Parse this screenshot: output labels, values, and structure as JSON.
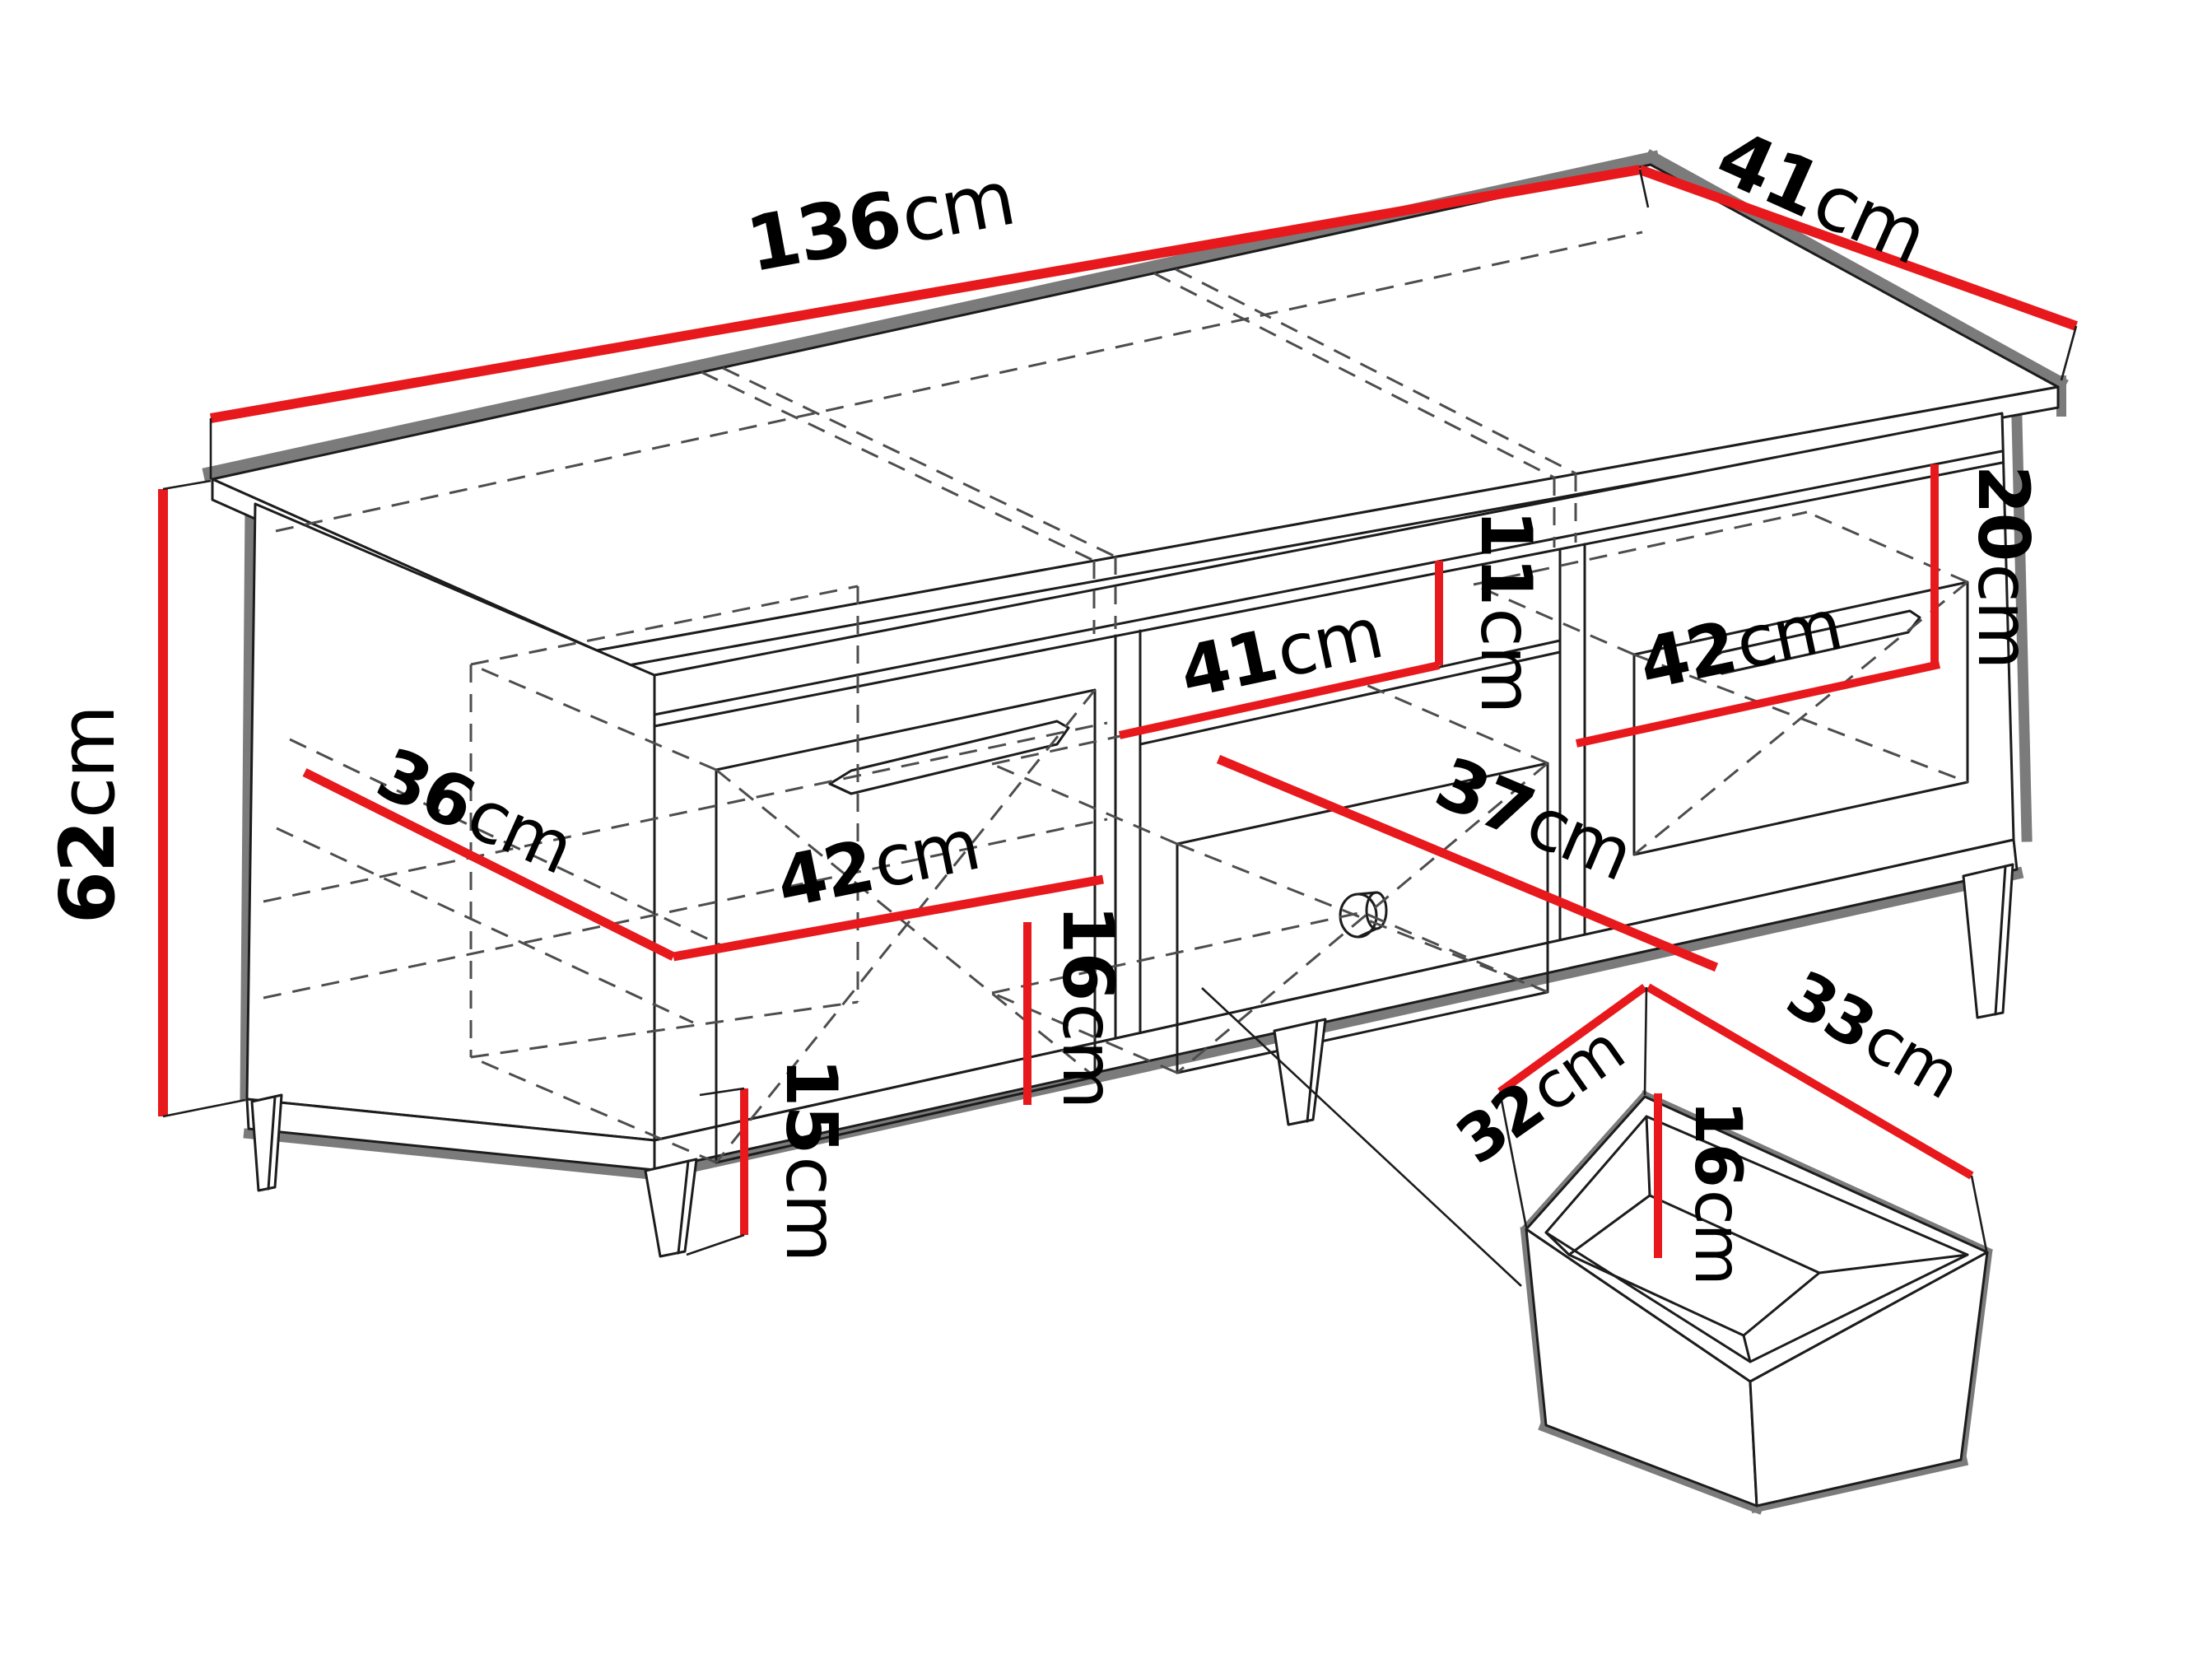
{
  "diagram": {
    "colors": {
      "measure_red": "#e8191d",
      "outline_black": "#1c1c1c",
      "shadow_gray": "#7b7b7b",
      "dashed_gray": "#4d4d4d",
      "background": "#ffffff"
    },
    "labels": {
      "width": {
        "value": "136",
        "unit": "cm"
      },
      "top_depth": {
        "value": "41",
        "unit": "cm"
      },
      "height": {
        "value": "62",
        "unit": "cm"
      },
      "left_inner_depth": {
        "value": "36",
        "unit": "cm"
      },
      "left_drawer_width": {
        "value": "42",
        "unit": "cm"
      },
      "left_drawer_front_height": {
        "value": "16",
        "unit": "cm"
      },
      "middle_opening_width": {
        "value": "41",
        "unit": "cm"
      },
      "top_gap_height": {
        "value": "11",
        "unit": "cm"
      },
      "middle_drawer_depth": {
        "value": "37",
        "unit": "cm"
      },
      "right_opening_height": {
        "value": "20",
        "unit": "cm"
      },
      "right_drawer_width": {
        "value": "42",
        "unit": "cm"
      },
      "leg_height": {
        "value": "15",
        "unit": "cm"
      },
      "drawer_box_depth": {
        "value": "32",
        "unit": "cm"
      },
      "drawer_box_width": {
        "value": "33",
        "unit": "cm"
      },
      "drawer_box_height": {
        "value": "16",
        "unit": "cm"
      }
    }
  }
}
